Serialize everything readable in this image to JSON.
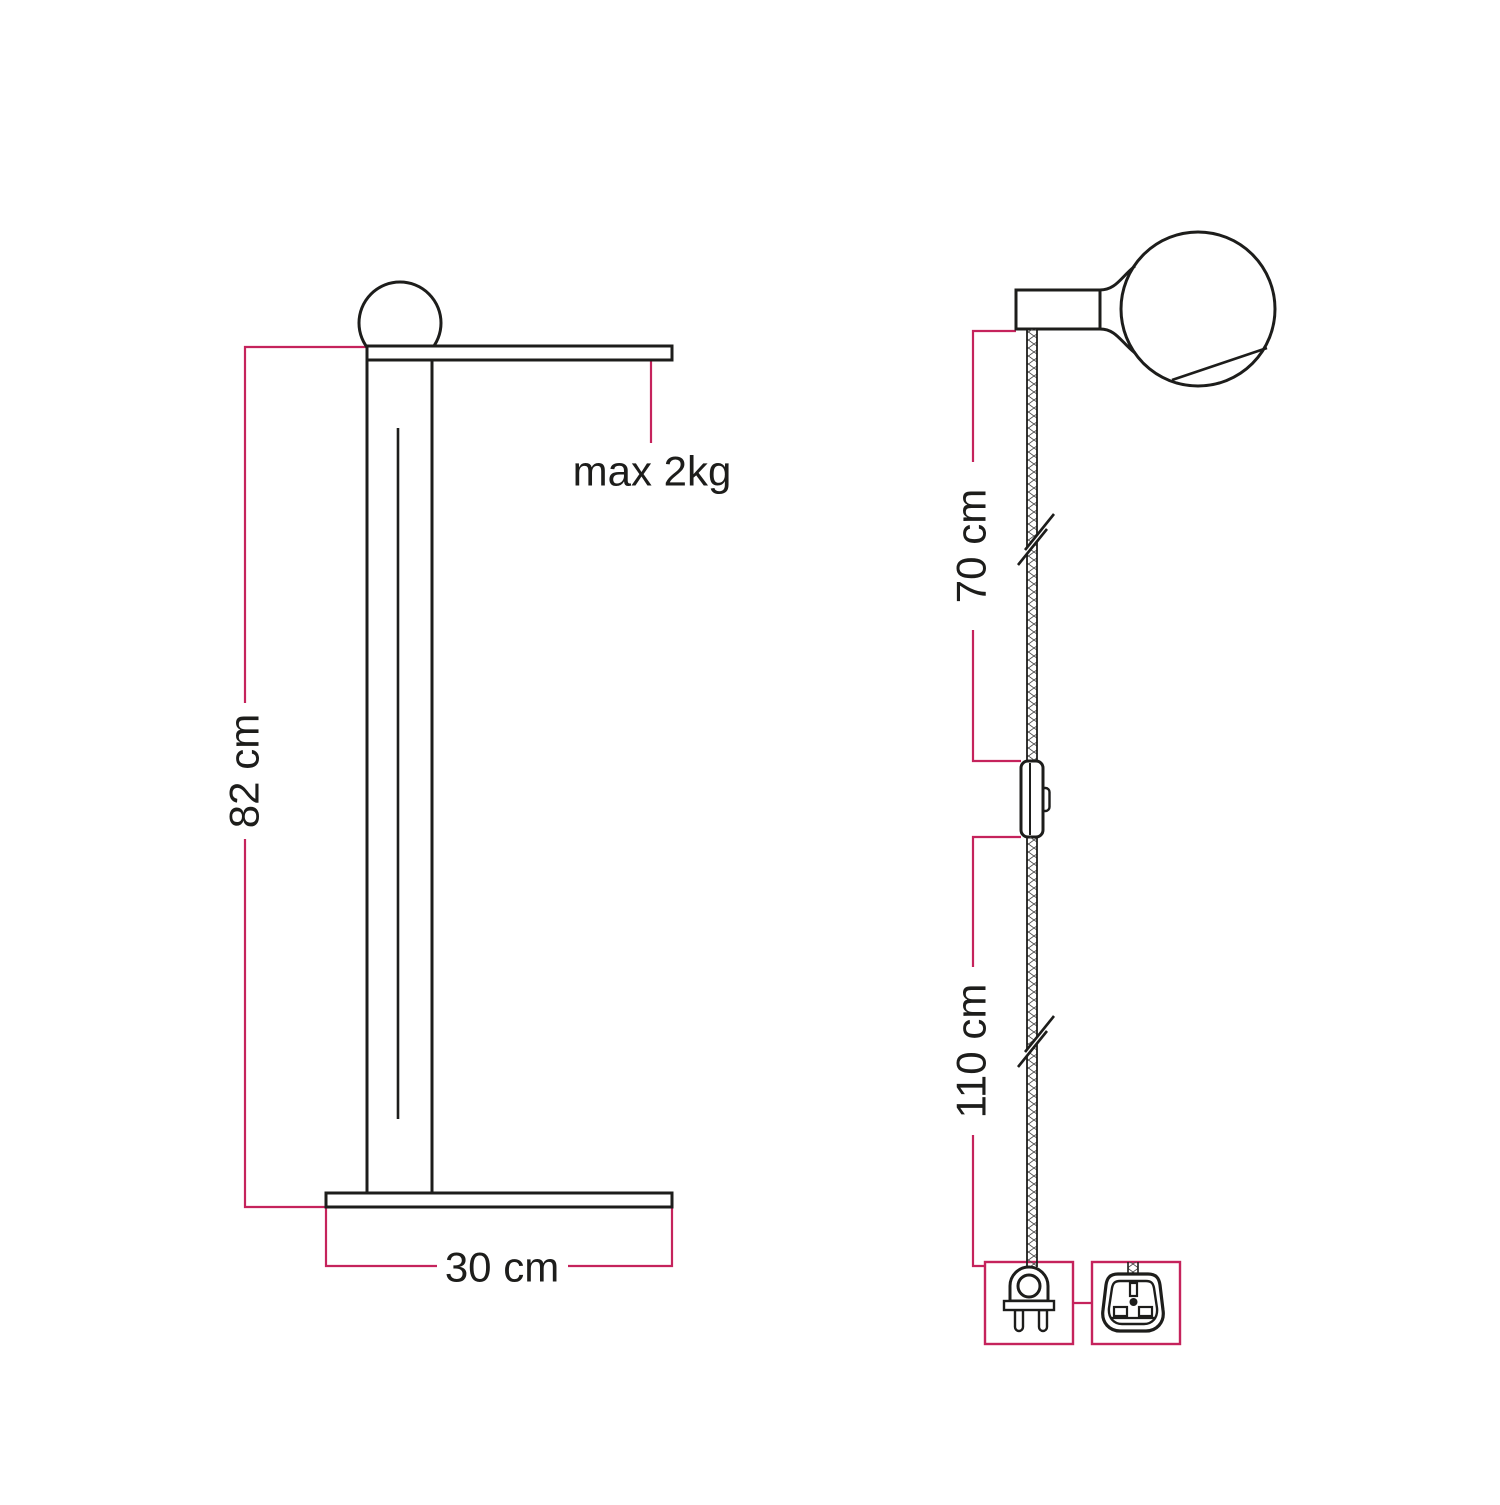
{
  "diagram": {
    "background_color": "#ffffff",
    "outline_color": "#1d1d1b",
    "dimension_color": "#c5235c",
    "text_color": "#1d1d1b",
    "front_view": {
      "height_label": "82 cm",
      "base_width_label": "30 cm",
      "max_load_label": "max 2kg"
    },
    "side_view": {
      "upper_cable_label": "70 cm",
      "lower_cable_label": "110 cm"
    },
    "icons": {
      "bulb": "light-bulb",
      "switch": "inline-switch",
      "eu_plug": "two-pin-plug",
      "uk_plug": "uk-three-pin-plug"
    }
  }
}
